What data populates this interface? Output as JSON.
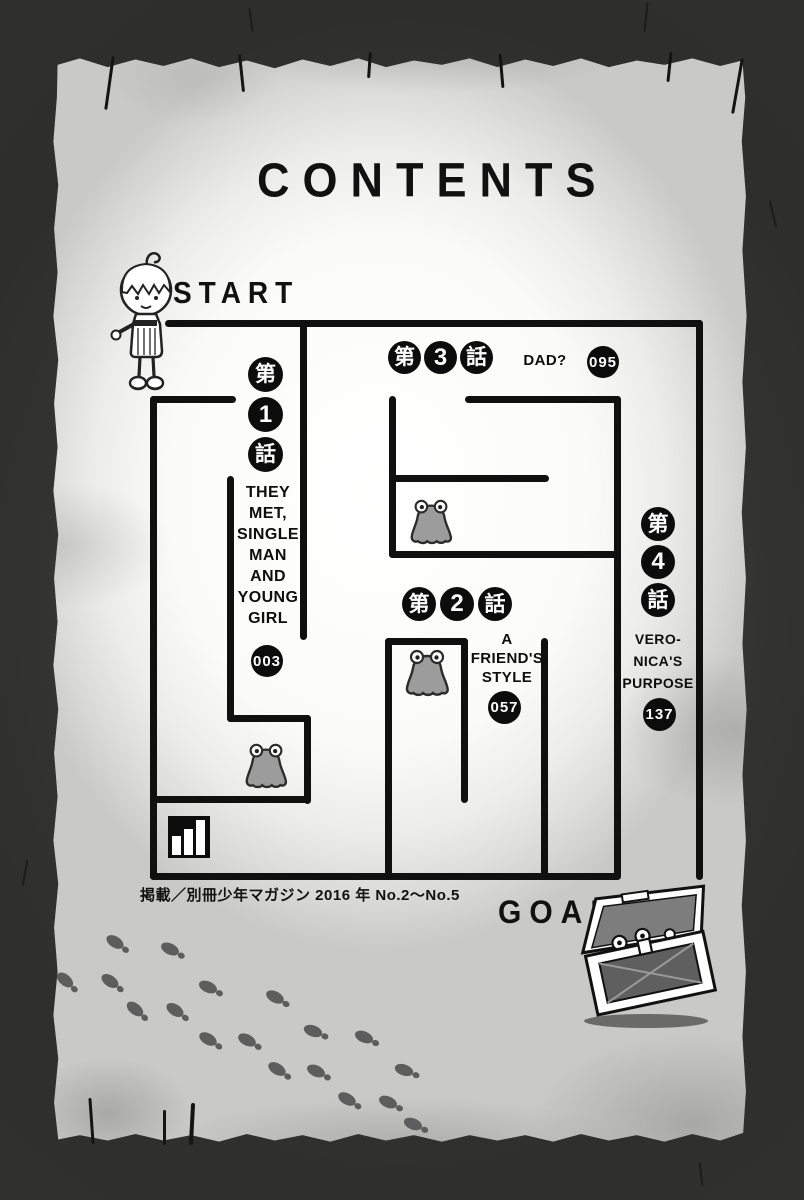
{
  "page_title": "CONTENTS",
  "start_label": "START",
  "goal_label": "GOAL",
  "footer_note": "掲載／別冊少年マガジン 2016 年 No.2～No.5",
  "chapters": [
    {
      "badge": [
        "第",
        "1",
        "話"
      ],
      "title_lines": [
        "THEY",
        "MET,",
        "SINGLE",
        "MAN",
        "AND",
        "YOUNG",
        "GIRL"
      ],
      "page": "003"
    },
    {
      "badge": [
        "第",
        "2",
        "話"
      ],
      "title_lines": [
        "A",
        "FRIEND'S",
        "STYLE"
      ],
      "page": "057"
    },
    {
      "badge": [
        "第",
        "3",
        "話"
      ],
      "title_lines": [
        "DAD?"
      ],
      "page": "095"
    },
    {
      "badge": [
        "第",
        "4",
        "話"
      ],
      "title_lines": [
        "VERO-",
        "NICA'S",
        "PURPOSE"
      ],
      "page": "137"
    }
  ],
  "icons": {
    "start_character": "chibi-girl-character",
    "goal_chest": "open-treasure-chest",
    "slime": "slime-monster",
    "bar_chart": "level-bars",
    "footprints": "footprint-trail"
  },
  "colors": {
    "border": "#3c3c3a",
    "parchment": "#f7f7f5",
    "maze_line": "#101010",
    "badge_bg": "#0c0c0c",
    "badge_text": "#ffffff",
    "slime_body": "#9c9c9c",
    "footprint": "#5d5d5d"
  }
}
